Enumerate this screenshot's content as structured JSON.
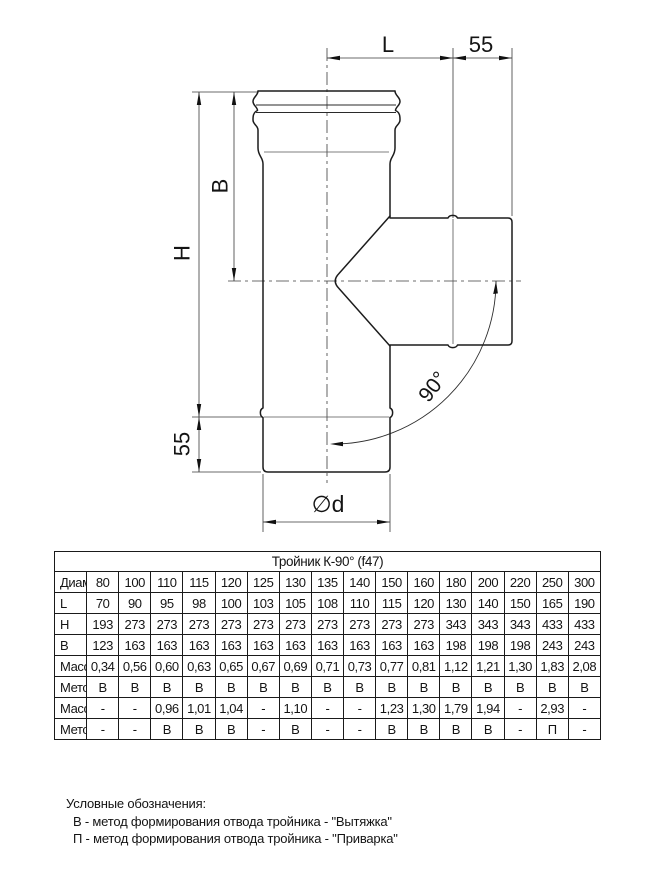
{
  "drawing": {
    "labels": {
      "length_l": "L",
      "top_offset": "55",
      "height_b": "B",
      "height_h": "H",
      "bottom_offset": "55",
      "diameter": "∅d",
      "angle": "90°"
    }
  },
  "table": {
    "title": "Тройник К-90° (f47)",
    "rows": [
      {
        "label": "Диаметр",
        "values": [
          "80",
          "100",
          "110",
          "115",
          "120",
          "125",
          "130",
          "135",
          "140",
          "150",
          "160",
          "180",
          "200",
          "220",
          "250",
          "300"
        ]
      },
      {
        "label": "L",
        "values": [
          "70",
          "90",
          "95",
          "98",
          "100",
          "103",
          "105",
          "108",
          "110",
          "115",
          "120",
          "130",
          "140",
          "150",
          "165",
          "190"
        ]
      },
      {
        "label": "H",
        "values": [
          "193",
          "273",
          "273",
          "273",
          "273",
          "273",
          "273",
          "273",
          "273",
          "273",
          "273",
          "343",
          "343",
          "343",
          "433",
          "433"
        ]
      },
      {
        "label": "B",
        "values": [
          "123",
          "163",
          "163",
          "163",
          "163",
          "163",
          "163",
          "163",
          "163",
          "163",
          "163",
          "198",
          "198",
          "198",
          "243",
          "243"
        ]
      },
      {
        "label": "Масса 0,5",
        "values": [
          "0,34",
          "0,56",
          "0,60",
          "0,63",
          "0,65",
          "0,67",
          "0,69",
          "0,71",
          "0,73",
          "0,77",
          "0,81",
          "1,12",
          "1,21",
          "1,30",
          "1,83",
          "2,08"
        ]
      },
      {
        "label": "Метод 0,5",
        "values": [
          "В",
          "В",
          "В",
          "В",
          "В",
          "В",
          "В",
          "В",
          "В",
          "В",
          "В",
          "В",
          "В",
          "В",
          "В",
          "В"
        ]
      },
      {
        "label": "Масса 0,8",
        "values": [
          "-",
          "-",
          "0,96",
          "1,01",
          "1,04",
          "-",
          "1,10",
          "-",
          "-",
          "1,23",
          "1,30",
          "1,79",
          "1,94",
          "-",
          "2,93",
          "-"
        ]
      },
      {
        "label": "Метод 0,8",
        "values": [
          "-",
          "-",
          "В",
          "В",
          "В",
          "-",
          "В",
          "-",
          "-",
          "В",
          "В",
          "В",
          "В",
          "-",
          "П",
          "-"
        ]
      }
    ]
  },
  "legend": {
    "title": "Условные обозначения:",
    "items": [
      "В - метод формирования отвода тройника - \"Вытяжка\"",
      "П - метод формирования отвода тройника - \"Приварка\""
    ]
  }
}
